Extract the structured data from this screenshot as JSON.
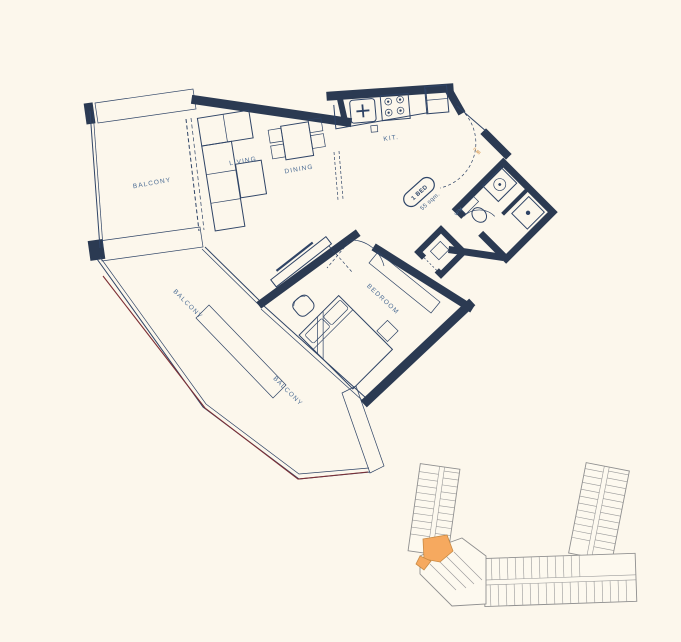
{
  "plan": {
    "rooms": {
      "balcony_top": {
        "label": "BALCONY"
      },
      "balcony_mid": {
        "label": "BALCONY"
      },
      "balcony_bottom": {
        "label": "BALCONY"
      },
      "living": {
        "label": "LIVING"
      },
      "dining": {
        "label": "DINING"
      },
      "kitchen": {
        "label": "KIT."
      },
      "bedroom": {
        "label": "BEDROOM"
      },
      "laundry": {
        "label": "W/M"
      }
    },
    "unit_badge": {
      "type": "1 BED",
      "area": "55 sqm."
    },
    "entry": {
      "door_dimension": "0.88"
    },
    "colors": {
      "wall": "#2b3a52",
      "label_blue": "#4b6c94",
      "railing_red": "#7d2f35",
      "background": "#fcf7ec",
      "keyplan_line": "#8f8f8f",
      "highlight_orange": "#f6a95f"
    }
  },
  "keyplan": {
    "highlighted_unit_color": "#f6a95f"
  }
}
